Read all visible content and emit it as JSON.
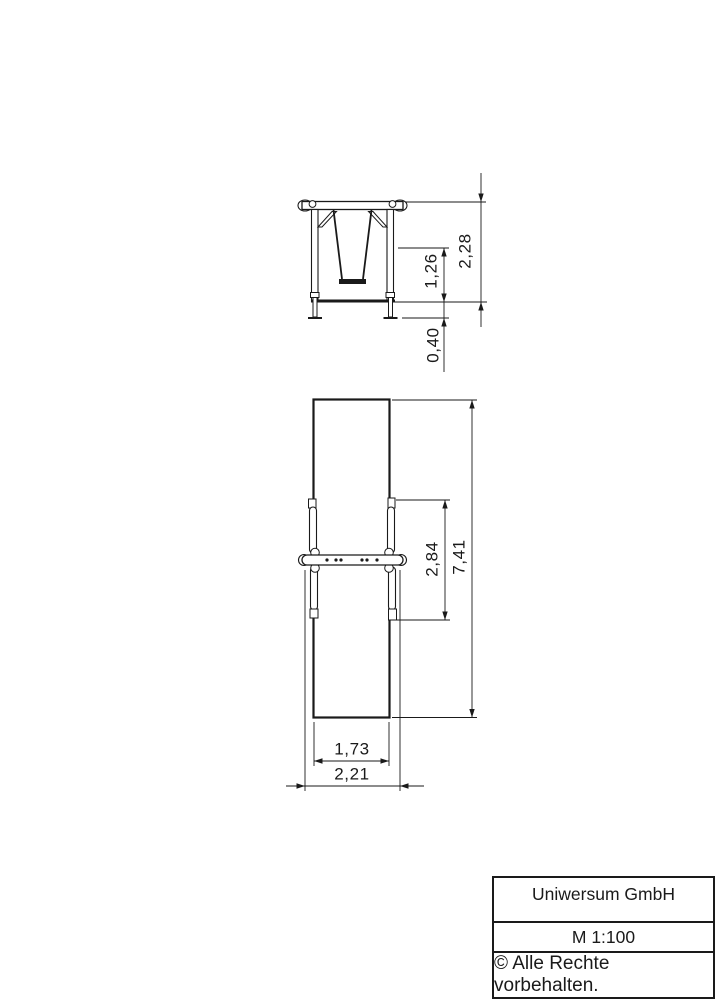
{
  "front_view": {
    "label": "front-elevation-of-swing",
    "dimensions": {
      "total_height": "2,28",
      "seat_height": "1,26",
      "foundation_depth": "0,40"
    }
  },
  "plan_view": {
    "label": "top-plan-of-swing",
    "dimensions": {
      "safety_zone_length": "7,41",
      "frame_depth": "2,84",
      "safety_zone_width": "1,73",
      "frame_width": "2,21"
    }
  },
  "title_block": {
    "company": "Uniwersum GmbH",
    "scale": "M 1:100",
    "copyright": "© Alle Rechte vorbehalten."
  },
  "colors": {
    "line": "#1a1a1a",
    "background": "#ffffff"
  }
}
